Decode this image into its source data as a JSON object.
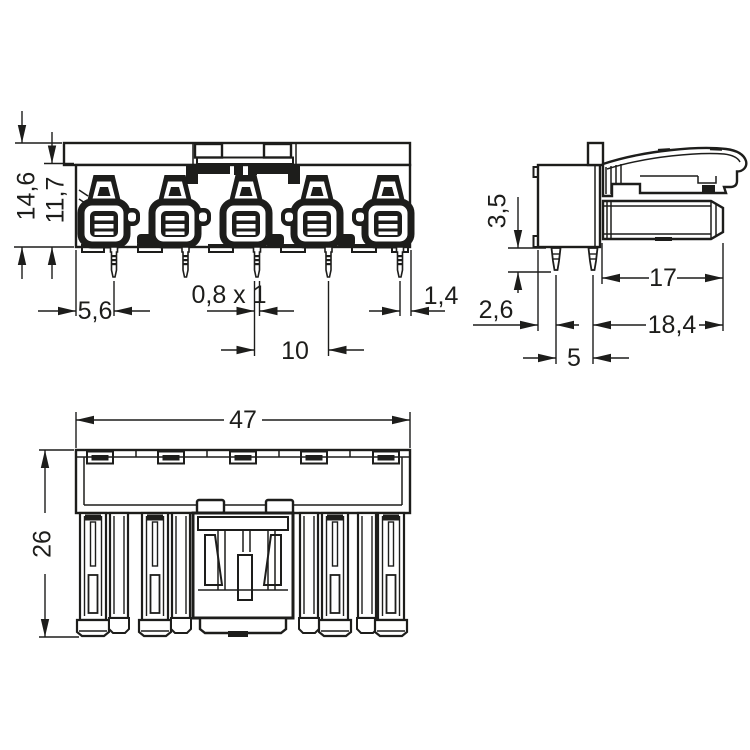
{
  "drawing": {
    "type": "technical-dimension-drawing",
    "subject": "5-pole PCB connector, three orthographic views",
    "colors": {
      "background": "#ffffff",
      "line": "#1d1d1b"
    },
    "views": {
      "front": {
        "name": "front view",
        "dims": {
          "total_height": "14,6",
          "body_height": "11,7",
          "first_pin_offset": "5,6",
          "pin_cross_section": "0,8 x 1",
          "pin_pitch": "10",
          "last_pin_offset": "1,4"
        }
      },
      "side": {
        "name": "side view",
        "dims": {
          "pin_length": "3,5",
          "pin_setback": "2,6",
          "plug_depth": "17",
          "overall_depth": "18,4",
          "pin_spacing": "5"
        }
      },
      "bottom": {
        "name": "bottom view",
        "dims": {
          "overall_width": "47",
          "overall_height": "26"
        }
      }
    }
  }
}
